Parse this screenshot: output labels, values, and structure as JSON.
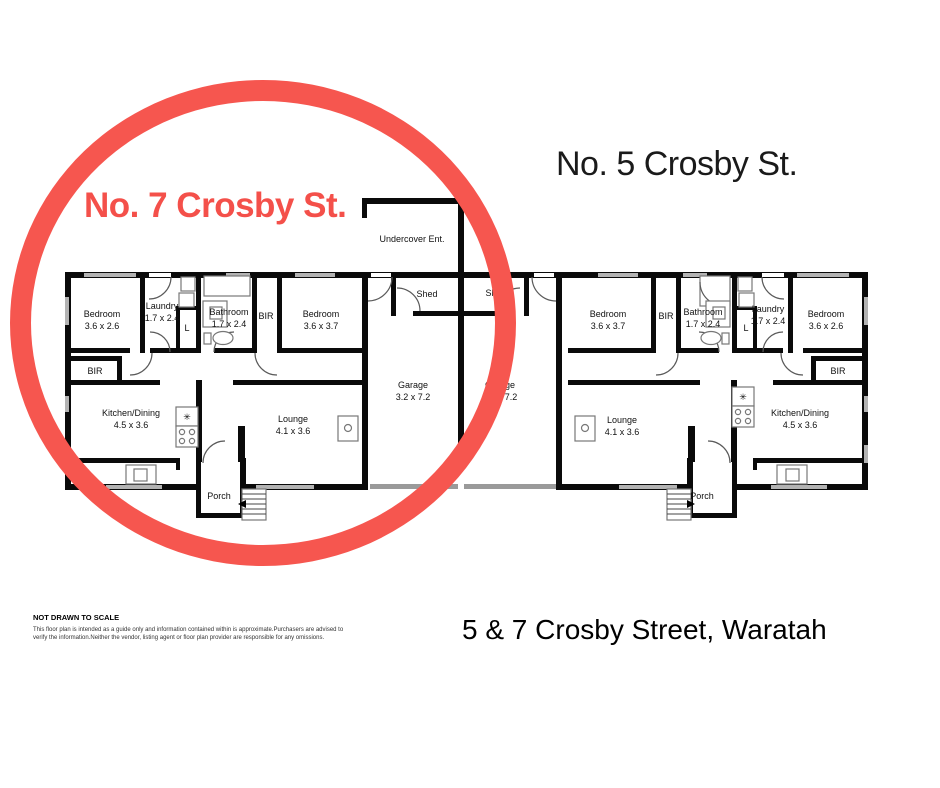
{
  "titles": {
    "unit7": "No. 7 Crosby St.",
    "unit5": "No. 5 Crosby St.",
    "address": "5 & 7 Crosby Street, Waratah"
  },
  "annotation": {
    "circle_color": "#f6564f",
    "accent_red": "#f4504a"
  },
  "disclaimer": {
    "heading": "NOT DRAWN TO SCALE",
    "line1": "This floor plan is intended as a guide only and information contained within is approximate.Purchasers are advised to",
    "line2": "verify the information.Neither the vendor, listing agent or floor plan provider are responsible for any omissions."
  },
  "plan": {
    "unit7": {
      "bedroom_front": {
        "name": "Bedroom",
        "dims": "3.6 x 2.6"
      },
      "laundry": {
        "name": "Laundry",
        "dims": "1.7 x 2.4"
      },
      "linen": "L",
      "bathroom": {
        "name": "Bathroom",
        "dims": "1.7 x 2.4"
      },
      "bir_hall": "BIR",
      "bedroom_rear": {
        "name": "Bedroom",
        "dims": "3.6 x 3.7"
      },
      "bir_front": "BIR",
      "kitchen": {
        "name": "Kitchen/Dining",
        "dims": "4.5 x 3.6"
      },
      "lounge": {
        "name": "Lounge",
        "dims": "4.1 x 3.6"
      },
      "porch": "Porch"
    },
    "shared": {
      "undercover": "Undercover Ent.",
      "sheds": [
        "Shed",
        "Shed"
      ],
      "garages": [
        {
          "name": "Garage",
          "dims": "3.2 x 7.2"
        },
        {
          "name": "Garage",
          "dims": "3.2 x 7.2"
        }
      ]
    },
    "unit5": {
      "bedroom_rear": {
        "name": "Bedroom",
        "dims": "3.6 x 3.7"
      },
      "bir_hall": "BIR",
      "bathroom": {
        "name": "Bathroom",
        "dims": "1.7 x 2.4"
      },
      "linen": "L",
      "laundry": {
        "name": "Laundry",
        "dims": "1.7 x 2.4"
      },
      "bedroom_front": {
        "name": "Bedroom",
        "dims": "3.6 x 2.6"
      },
      "bir_front": "BIR",
      "lounge": {
        "name": "Lounge",
        "dims": "4.1 x 3.6"
      },
      "kitchen": {
        "name": "Kitchen/Dining",
        "dims": "4.5 x 3.6"
      },
      "porch": "Porch"
    }
  },
  "icons": {
    "cooktop_glyph": "✳"
  }
}
